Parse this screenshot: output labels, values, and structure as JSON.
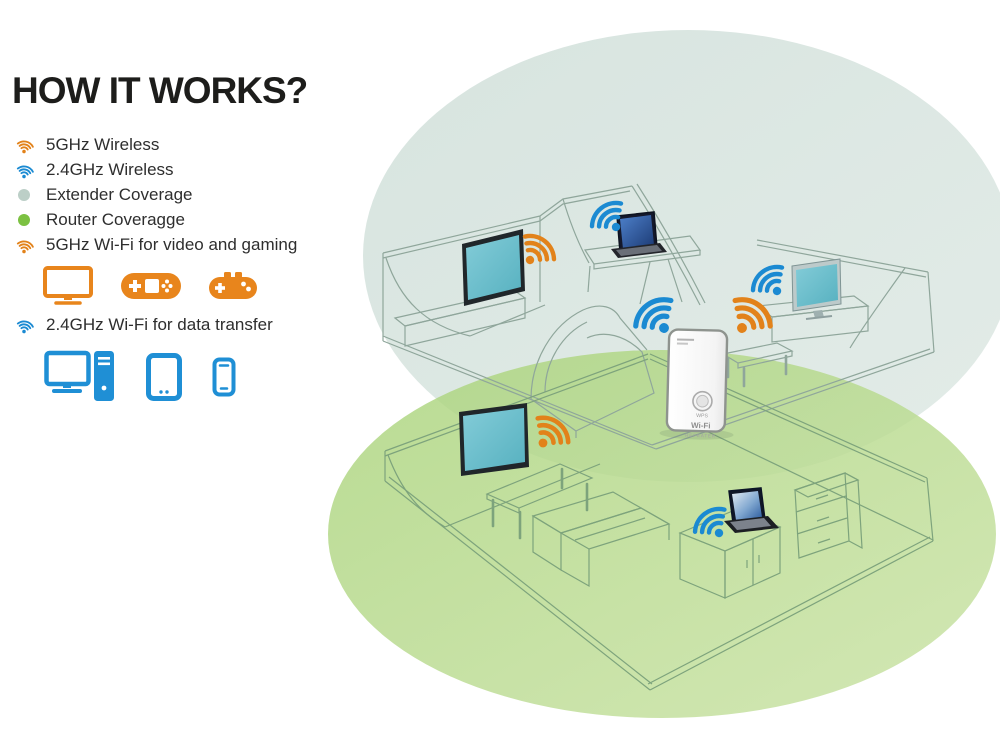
{
  "title": "HOW IT WORKS?",
  "legend": {
    "items": [
      {
        "icon": "wifi-5ghz-icon",
        "label": "5GHz Wireless"
      },
      {
        "icon": "wifi-24ghz-icon",
        "label": "2.4GHz Wireless"
      },
      {
        "icon": "extender-coverage-dot",
        "label": "Extender Coverage"
      },
      {
        "icon": "router-coverage-dot",
        "label": "Router Coveragge"
      },
      {
        "icon": "wifi-5ghz-icon",
        "label": "5GHz Wi-Fi for video and gaming"
      },
      {
        "icon": "wifi-24ghz-icon",
        "label": "2.4GHz Wi-Fi for data transfer"
      }
    ],
    "video_gaming_devices": [
      "tv",
      "handheld-game-console",
      "gamepad"
    ],
    "data_transfer_devices": [
      "desktop-computer",
      "tablet",
      "smartphone"
    ]
  },
  "extender": {
    "wps_label": "WPS",
    "wifi_label": "Wi-Fi",
    "repeater_label": "REPEATER"
  },
  "illustration": {
    "upper_room_devices": [
      {
        "device": "wall-tv",
        "band": "5GHz"
      },
      {
        "device": "laptop-on-desk",
        "band": "2.4GHz"
      },
      {
        "device": "monitor-on-cabinet",
        "band": "2.4GHz"
      },
      {
        "device": "wifi-extender",
        "bands": [
          "2.4GHz",
          "5GHz"
        ]
      }
    ],
    "lower_room_devices": [
      {
        "device": "wall-tv",
        "band": "5GHz"
      },
      {
        "device": "laptop-on-cabinet",
        "band": "2.4GHz"
      }
    ]
  },
  "colors": {
    "wifi_5ghz_orange": "#E2821A",
    "wifi_24ghz_blue": "#1B8AD2",
    "extender_coverage_fill": "#DCE7E2",
    "router_coverage_fill": "#AFD480",
    "extender_coverage_dot": "#BCCFC7",
    "router_coverage_dot": "#7CC142",
    "tv_screen_teal": "#6FBCCB",
    "upper_room_lines": "#8FA69B",
    "lower_room_lines": "#7DA37C",
    "title_text": "#1D1D1B"
  }
}
